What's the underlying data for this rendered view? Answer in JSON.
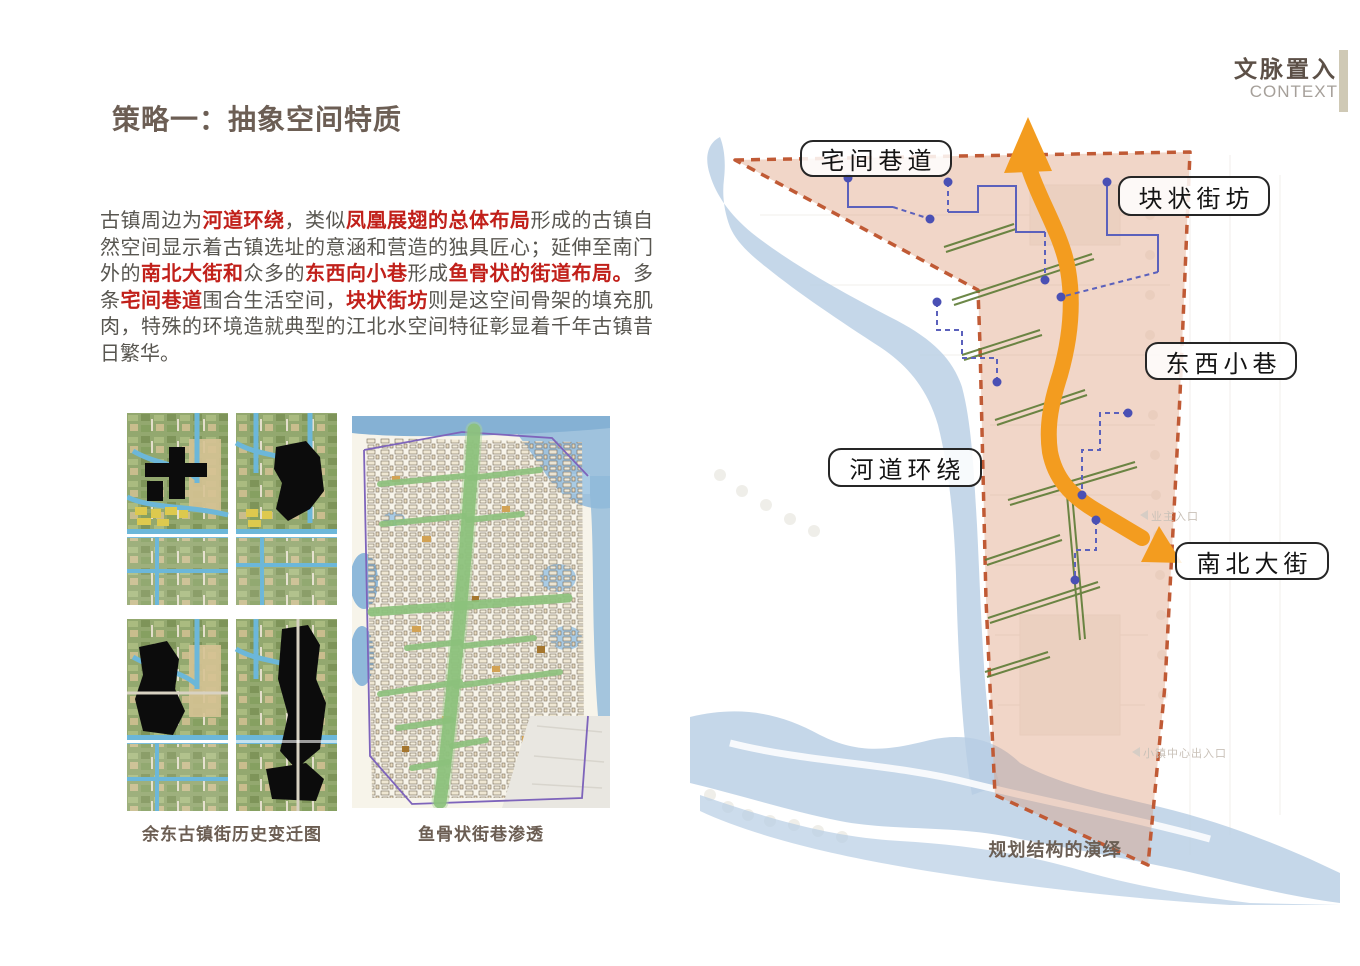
{
  "header": {
    "title": "文脉置入",
    "subtitle": "CONTEXT",
    "accent_bar_color": "#cfc9b5"
  },
  "strategy": {
    "heading": "策略一：抽象空间特质"
  },
  "intro": {
    "segments": [
      {
        "text": "古镇周边为",
        "red": false
      },
      {
        "text": "河道环绕",
        "red": true
      },
      {
        "text": "，类似",
        "red": false
      },
      {
        "text": "凤凰展翅的总体布局",
        "red": true
      },
      {
        "text": "形成的古镇自然空间显示着古镇选址的意涵和营造的独具匠心；延伸至南门外的",
        "red": false
      },
      {
        "text": "南北大街和",
        "red": true
      },
      {
        "text": "众多的",
        "red": false
      },
      {
        "text": "东西向小巷",
        "red": true
      },
      {
        "text": "形成",
        "red": false
      },
      {
        "text": "鱼骨状的街道布局。",
        "red": true
      },
      {
        "text": "多条",
        "red": false
      },
      {
        "text": "宅间巷道",
        "red": true
      },
      {
        "text": "围合生活空间，",
        "red": false
      },
      {
        "text": "块状街坊",
        "red": true
      },
      {
        "text": "则是这空间骨架的填充肌肉，特殊的环境造就典型的江北水空间特征彰显着千年古镇昔日繁华。",
        "red": false
      }
    ]
  },
  "figures": {
    "left": {
      "caption": "余东古镇街历史变迁图"
    },
    "right": {
      "caption": "鱼骨状街巷渗透"
    }
  },
  "diagram": {
    "labels": [
      {
        "text": "宅间巷道"
      },
      {
        "text": "块状街坊"
      },
      {
        "text": "东西小巷"
      },
      {
        "text": "河道环绕"
      },
      {
        "text": "南北大街"
      }
    ],
    "faint_labels": [
      {
        "text": "业主入口"
      },
      {
        "text": "小镇中心出入口"
      }
    ],
    "caption": "规划结构的演绎",
    "colors": {
      "site_fill": "#e8cbb8",
      "site_border": "#c05a35",
      "river": "#b7cde4",
      "arrow": "#f39c1f",
      "lane_blue": "#5b61bc",
      "street_green": "#5d7c35"
    }
  }
}
